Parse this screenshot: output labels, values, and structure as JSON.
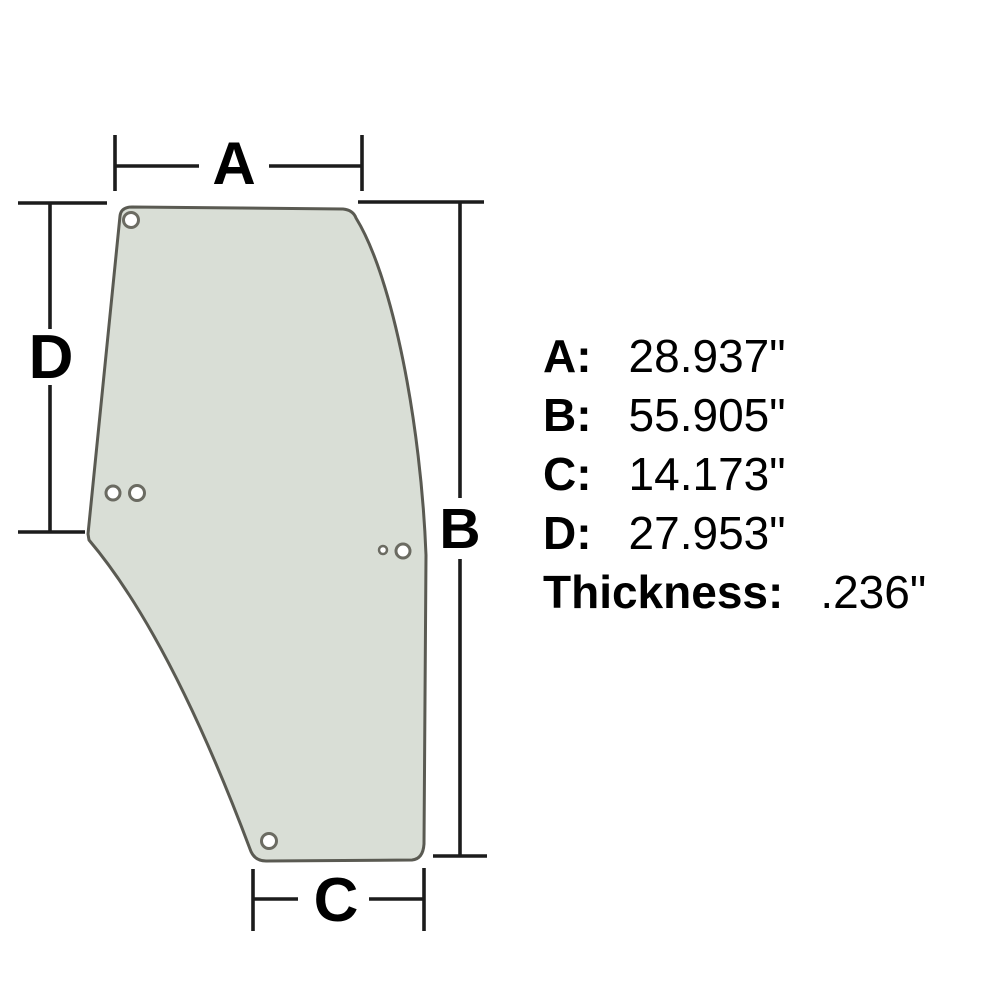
{
  "diagram": {
    "description": "glass-panel-dimension-diagram",
    "dims": {
      "a": "A",
      "b": "B",
      "c": "C",
      "d": "D"
    },
    "specs": [
      {
        "label": "A:",
        "value": "28.937\""
      },
      {
        "label": "B:",
        "value": "55.905\""
      },
      {
        "label": "C:",
        "value": "14.173\""
      },
      {
        "label": "D:",
        "value": "27.953\""
      },
      {
        "label": "Thickness:",
        "value": ".236\""
      }
    ],
    "colors": {
      "background": "#ffffff",
      "glass_fill": "#d9ded6",
      "glass_outline": "#5a5a52",
      "hole_stroke": "#6b6b62",
      "dimension_line": "#1c1c1c",
      "text": "#000000"
    }
  }
}
